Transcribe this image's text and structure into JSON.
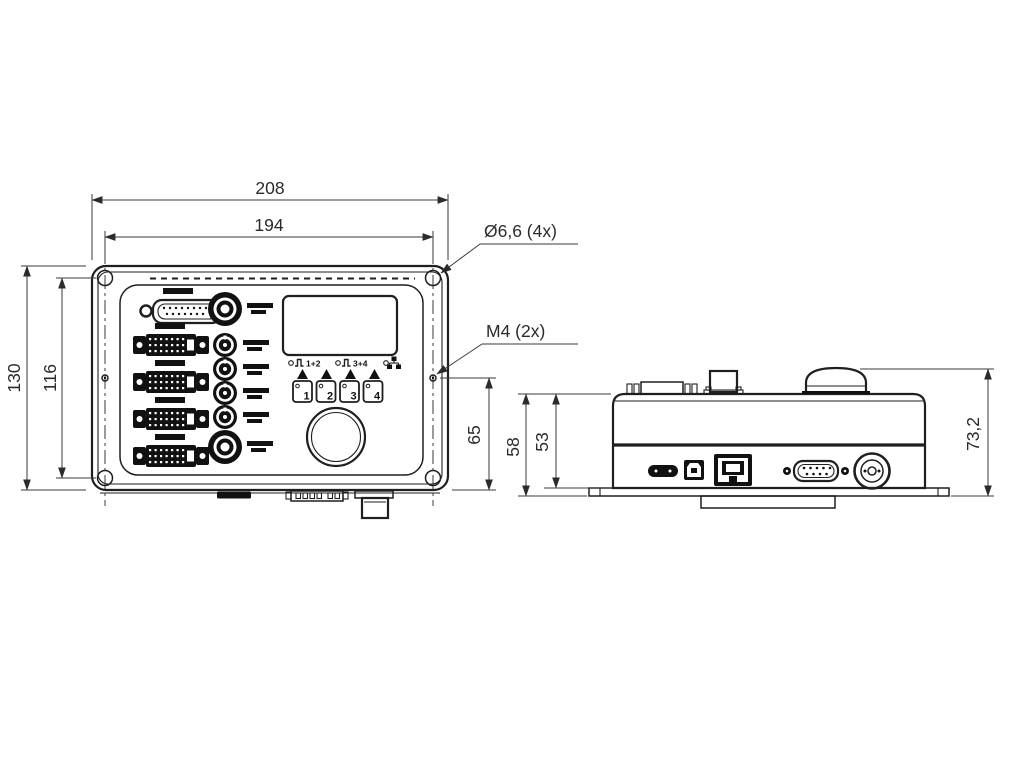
{
  "front_view": {
    "dim_overall_width": "208",
    "dim_hole_spacing_w": "194",
    "dim_overall_height": "130",
    "dim_hole_spacing_h": "116",
    "dim_m4_to_bottom": "65",
    "callout_corner_holes": "Ø6,6 (4x)",
    "callout_thread_holes": "M4 (2x)",
    "indicators": {
      "group1": "1+2",
      "group2": "3+4"
    },
    "buttons": [
      "1",
      "2",
      "3",
      "4"
    ]
  },
  "side_view": {
    "dim_height_with_flange": "58",
    "dim_body_height": "53",
    "dim_overall_height": "73,2"
  },
  "colors": {
    "line": "#1f1f1f",
    "dimension": "#3a3a3a",
    "background": "#ffffff"
  }
}
